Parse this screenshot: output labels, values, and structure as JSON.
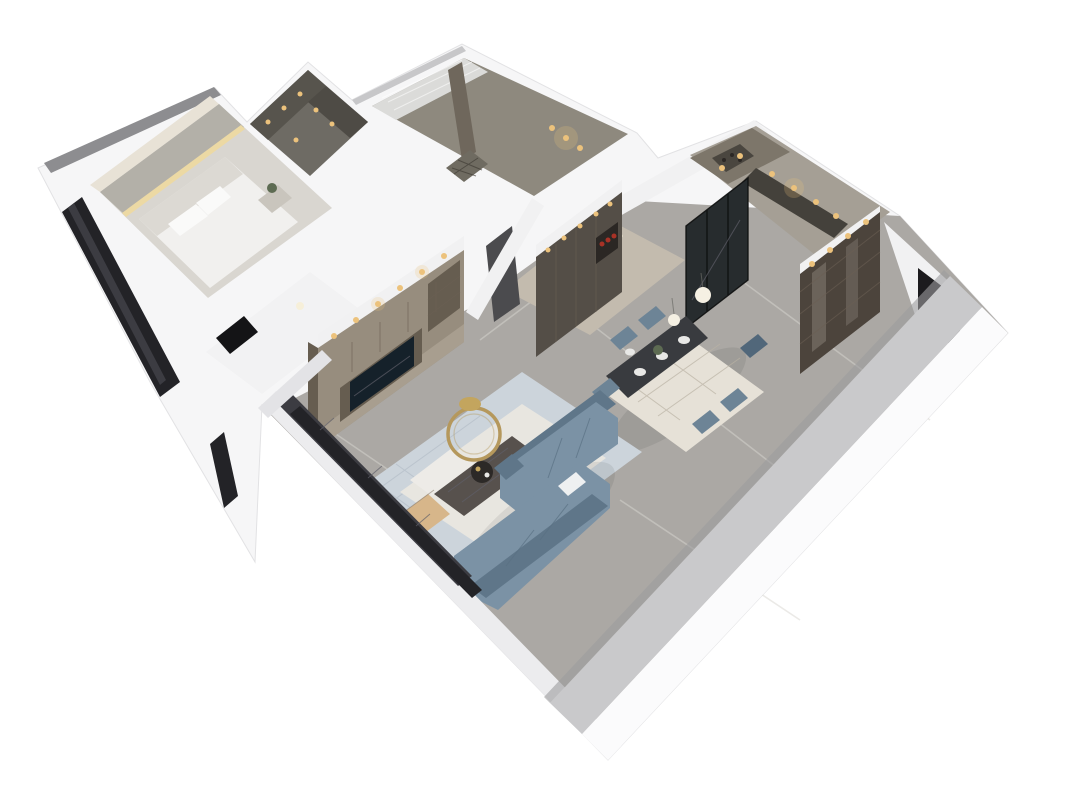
{
  "scene": {
    "title": "3D dollhouse cutaway render of an apartment floor plan, viewed from above at an angle on a white background",
    "view": "axonometric top-down cutaway, walls cut flat and shown white",
    "background": "#ffffff",
    "rooms": [
      {
        "name": "master-bedroom",
        "position": "upper-left",
        "contents": [
          "bed with ornate curved silver-white headboard",
          "white bedding and pillows",
          "textured accent wall with warm cove lighting",
          "light marble wall panel",
          "nightstand with small plant",
          "dark tinted floor-to-ceiling windows on the outer wall"
        ]
      },
      {
        "name": "walk-in-closet",
        "position": "top-left of center",
        "contents": [
          "dark open wardrobe shelving",
          "warm recessed downlights"
        ]
      },
      {
        "name": "second-bedroom-bathroom",
        "position": "top-center",
        "contents": [
          "white sheer curtains",
          "taupe walls",
          "shower floor with drain mat",
          "wardrobe niche with warm downlights"
        ]
      },
      {
        "name": "kitchen-bar",
        "position": "top-right",
        "contents": [
          "display shelving with wine bottles",
          "dark countertop",
          "warm accent downlights",
          "black-framed glass sliding doors"
        ]
      },
      {
        "name": "hallway-foyer",
        "position": "center",
        "contents": [
          "gray marble flooring",
          "dark interior door",
          "beige corridor floor"
        ]
      },
      {
        "name": "dining-area",
        "position": "center-right",
        "contents": [
          "dark rectangular dining table",
          "six blue-gray upholstered chairs",
          "white plates and centerpiece plant",
          "two glass globe pendant lights",
          "light patterned area rug",
          "dark sideboard wall with lit niche holding red objects"
        ]
      },
      {
        "name": "display-cabinet-room",
        "position": "right wing",
        "contents": [
          "tall brown glass-front display cabinet with spotlights",
          "dark doorway opening"
        ]
      },
      {
        "name": "living-room",
        "position": "bottom-center",
        "contents": [
          "L-shaped blue-gray sectional sofa with white throw pillow",
          "dark marble coffee table with round tray",
          "white side table",
          "round gold ring decor and gold dish",
          "tan leather accent chair",
          "blue-gray patterned rug with light inner panel",
          "built-in greige TV media wall with warm spotlights",
          "television with dark screen showing a faint wordmark",
          "tinted window band along the front-left wall"
        ]
      }
    ]
  },
  "colors": {
    "background": "#ffffff",
    "silhouette": "#f6f6f7",
    "roofEdge": "#8d8d90",
    "roofEdgeSoft": "#c7c7c9",
    "wallBand": "#ececee",
    "wallWhite": "#f1f1f2",
    "wallShade": "#e3e3e6",
    "frontWallOuter": "#fbfbfc",
    "frontWallTop": "#c9c9cb",
    "frontWallShadow": "#9c9c9e",
    "floorMarble": "#aba8a4",
    "bedroomFloor": "#d9d6d0",
    "marblePanel": "#e8e2d6",
    "accentWall": "#b3b0a8",
    "coveLight": "#ecd9a4",
    "bedding": "#f1f0ee",
    "headboard": "#dcd9d3",
    "pillow": "#fafaf9",
    "nightstand": "#c9c5bd",
    "plantGreen": "#5d6b52",
    "windowGlass": "#232327",
    "windowPane": "#3c3c42",
    "closetFloor": "#6e6b64",
    "closetShelf": "#57544d",
    "closetShelfDark": "#4e4b45",
    "warmLight": "#ecc27c",
    "bathroomWall": "#8e897e",
    "curtain": "#dbdbd9",
    "wardrobeColumn": "#6f675c",
    "showerFloor": "#6f6b61",
    "corridorFloor": "#c3bbae",
    "doorDark": "#4b4b4e",
    "kitchenFloor": "#a59f95",
    "kitchenCabinet": "#7d766a",
    "wineShelf": "#4a463f",
    "counterDark": "#44413b",
    "glassDoor": "#272c2e",
    "sideboard": "#544e47",
    "nicheDark": "#2b2724",
    "nicheRed": "#a83226",
    "cabinetBrown": "#4c443c",
    "cabinetShine": "#c8c0b4",
    "doorwayDark": "#1c1b1e",
    "diningRug": "#e6e1d7",
    "tableDark": "#393b3f",
    "chairBlue": "#6d8496",
    "chairBlueDark": "#51677a",
    "plate": "#e8e8e6",
    "pendantGlow": "#f5f0e3",
    "livingRug": "#ccd4db",
    "livingRugInner": "#e8e6e0",
    "sofaBlue": "#7b92a5",
    "sofaBlueDark": "#5f7689",
    "sofaPillow": "#eef0f1",
    "coffeeTable": "#57514d",
    "trayDark": "#2c2927",
    "sideTable": "#edebe7",
    "goldDish": "#c3a55e",
    "armchairTan": "#d7b68a",
    "tvCabinet": "#978d7e",
    "tvCabinetLight": "#a89e8f",
    "tvShelfDark": "#665d50",
    "tvScreen": "#15212a",
    "ceilingLight": "#f6efd9",
    "middleRoom": "#f2f2f3",
    "openingDark": "#141416"
  }
}
